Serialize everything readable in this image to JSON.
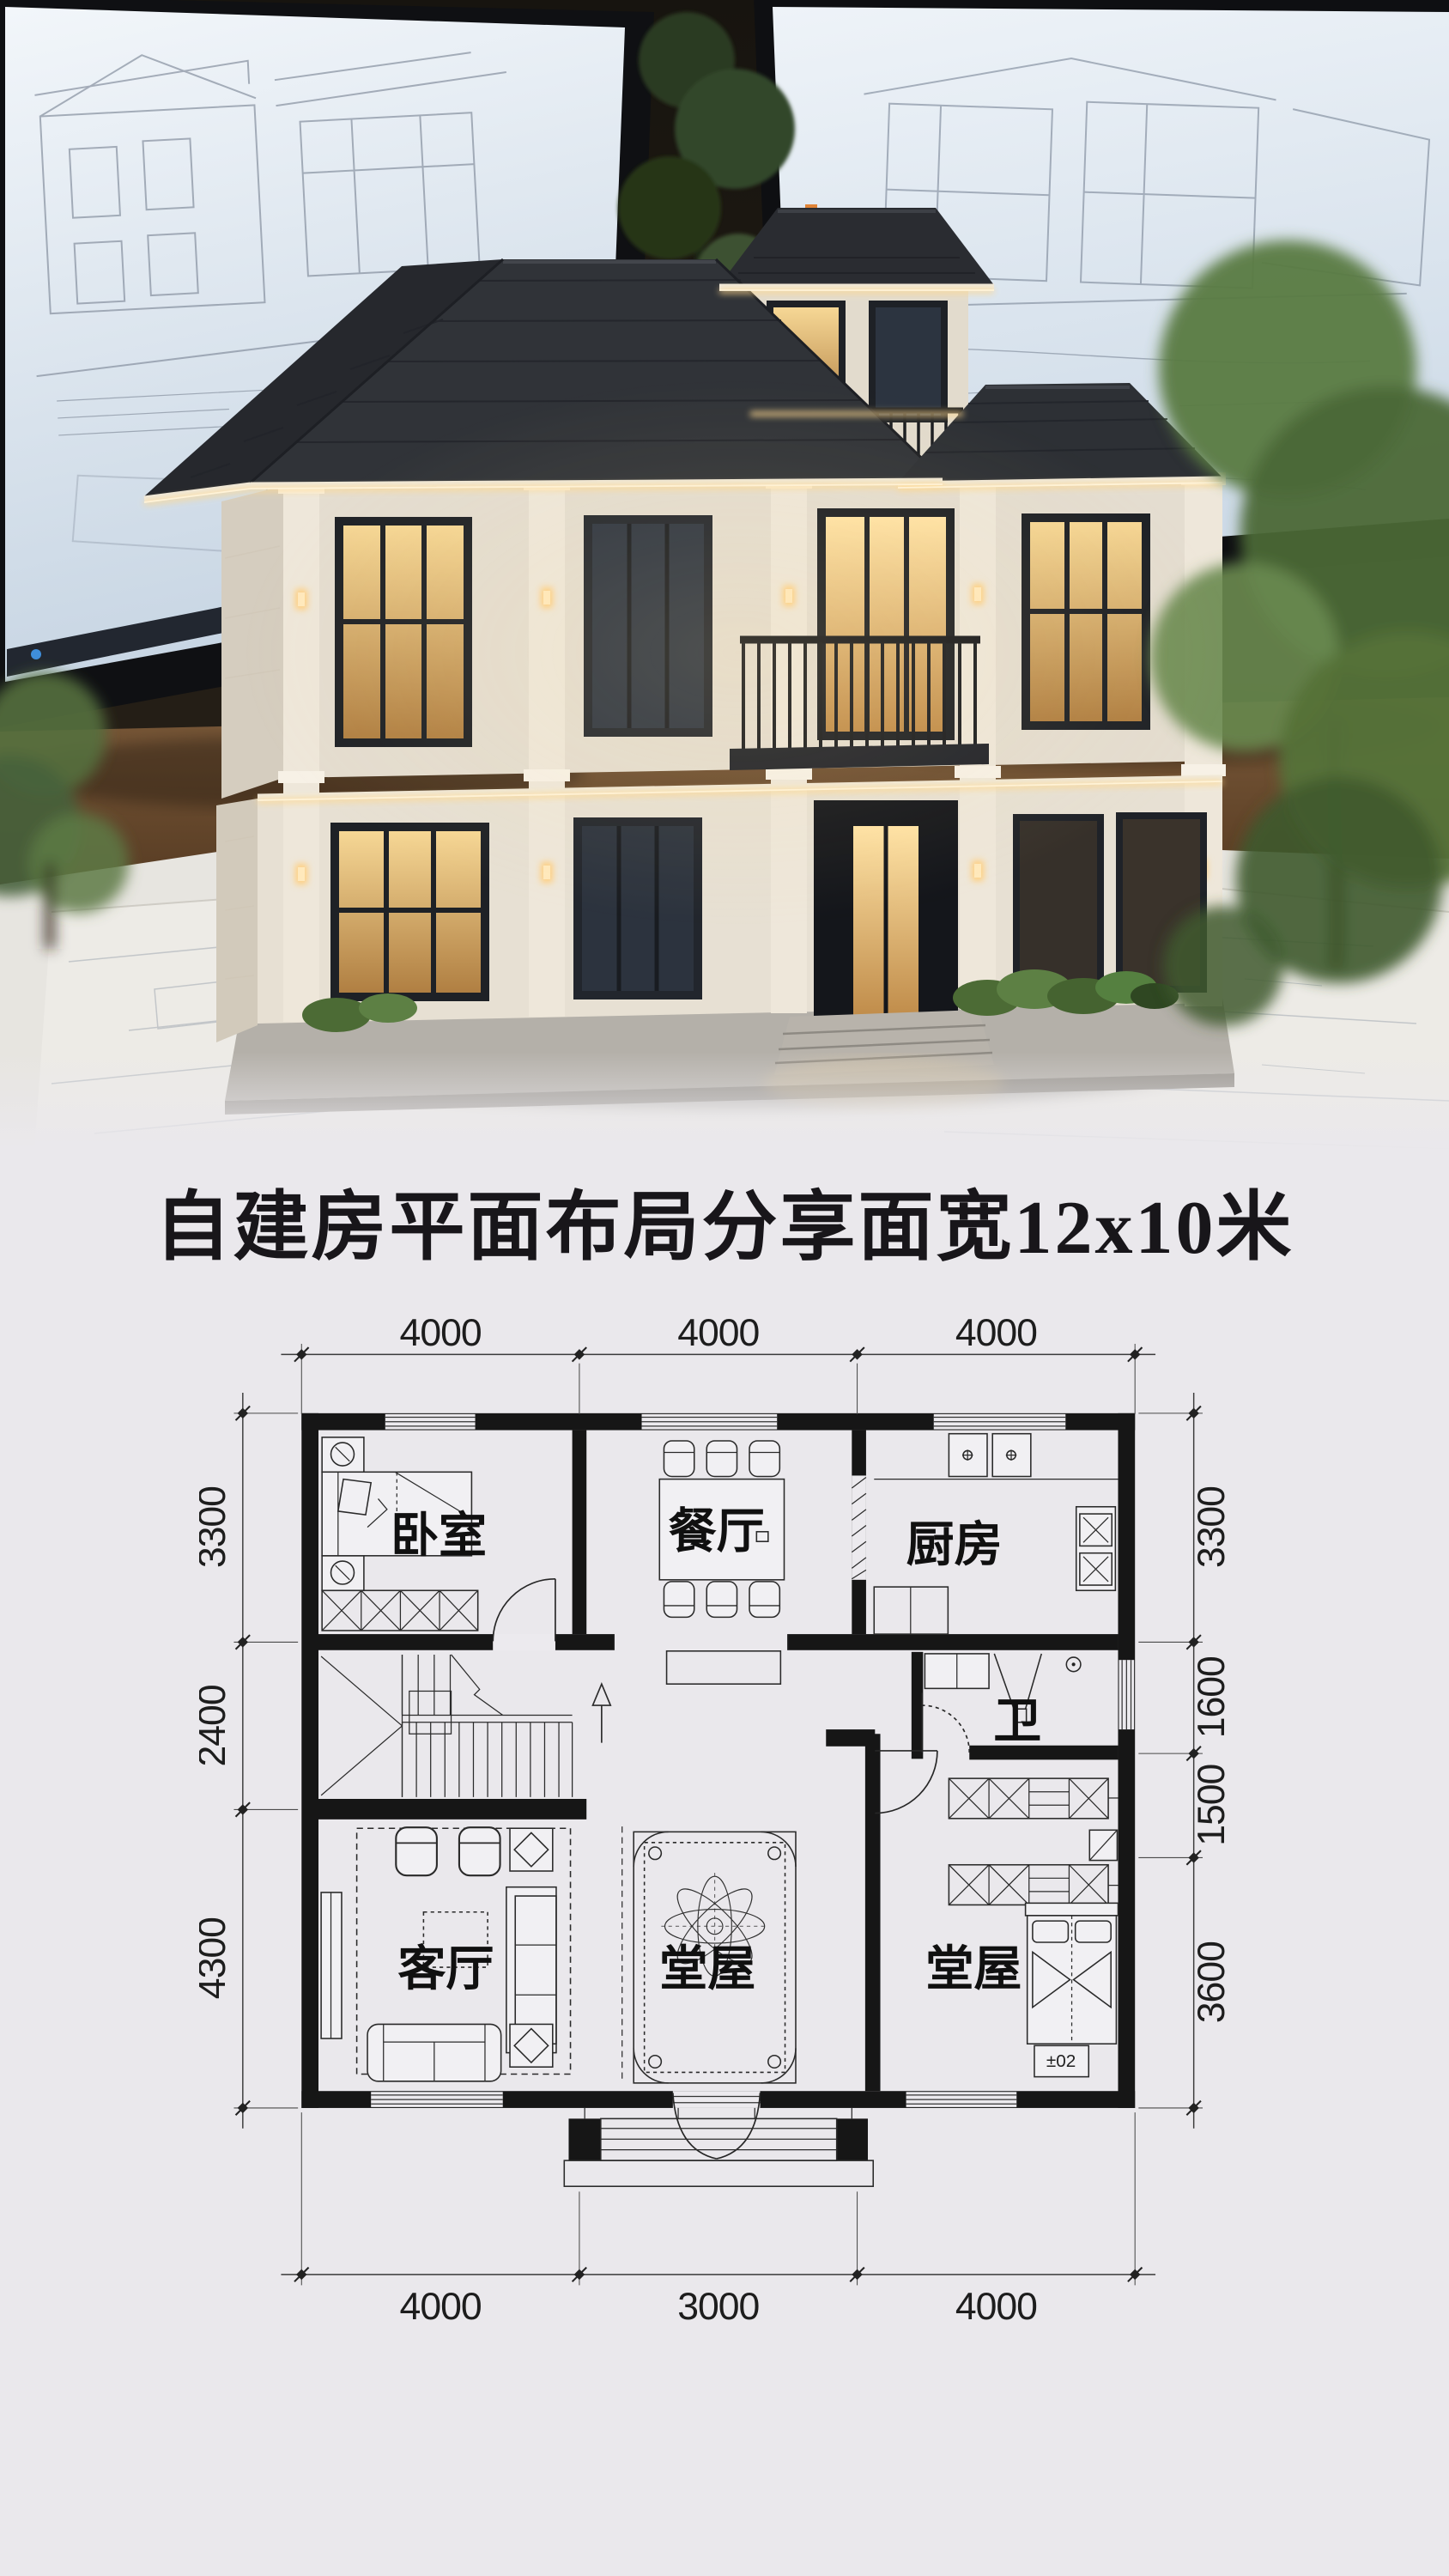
{
  "title": {
    "text": "自建房平面布局分享面宽12x10米"
  },
  "hero": {
    "description": "miniature two-storey villa scale model standing on architectural blueprint sheets, two monitors with CAD elevation drawings behind, green plants at both sides",
    "colors": {
      "roof": "#2e3136",
      "wall_cream": "#e6dfd2",
      "eave_glow": "#ffdf9e",
      "screen": "#e9eff6",
      "desk_wood": "#6e4f33",
      "foliage": "#55703f",
      "paper": "#e9e7e2"
    },
    "screen_toolbar_chips": [
      "#e08438",
      "#e3c43c",
      "#8fa7bd"
    ]
  },
  "floor_plan": {
    "rooms": [
      {
        "id": "bedroom",
        "label": "卧室"
      },
      {
        "id": "dining",
        "label": "餐厅"
      },
      {
        "id": "kitchen",
        "label": "厨房"
      },
      {
        "id": "bath",
        "label": "卫"
      },
      {
        "id": "living",
        "label": "客厅"
      },
      {
        "id": "hall-center",
        "label": "堂屋"
      },
      {
        "id": "hall-right",
        "label": "堂屋"
      }
    ],
    "dims": {
      "top": [
        "4000",
        "4000",
        "4000"
      ],
      "bottom": [
        "4000",
        "3000",
        "4000"
      ],
      "left": [
        "3300",
        "2400",
        "4300"
      ],
      "right": [
        "3300",
        "1600",
        "1500",
        "3600"
      ]
    },
    "overall": {
      "width_mm": 12000,
      "depth_mm": 10000
    },
    "annotations": {
      "stand_label": "±02",
      "stairs_direction": "up"
    }
  }
}
